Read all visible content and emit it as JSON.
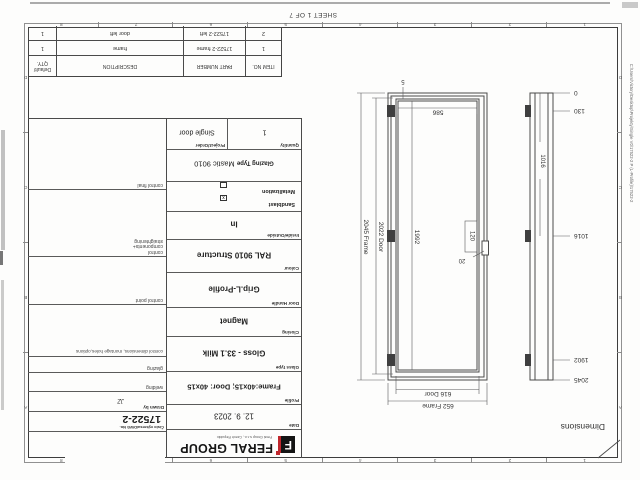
{
  "page": {
    "sheet_note": "SHEET 1 OF 7",
    "file_path": "C:\\Users\\Victory\\Desktop\\Projekty\\Single V0\\17522-2 P (L-Profile)\\17522-2"
  },
  "zones": {
    "numbers": [
      "1",
      "2",
      "3",
      "4",
      "5",
      "6",
      "7",
      "8"
    ],
    "letters": [
      "A",
      "B",
      "C",
      "D"
    ]
  },
  "drawing": {
    "view_label": "Dimensions",
    "dims": {
      "frame_width": "652 Frame",
      "door_width": "616 Door",
      "inner_width": "586",
      "frame_height": "2045 Frame",
      "door_height": "2022 Door",
      "inner_height": "1992",
      "bottom_gap": "5",
      "lock_box": "120",
      "lock_offset": "20",
      "bar_dim": "1016"
    },
    "ladder": [
      "0",
      "130",
      "1016",
      "1902",
      "2045"
    ]
  },
  "title_block": {
    "logo": {
      "text": "FERAL GROUP",
      "icon_letter": "F",
      "tagline": "Feral Group s.r.o., Czech Republic",
      "accent_color": "#c0272d"
    },
    "spec_rows": [
      {
        "label": "Date",
        "value": "12. 9. 2023"
      },
      {
        "label": "Profile",
        "value": "Frame:40x15; Door: 40x15"
      },
      {
        "label": "Glass type",
        "value": "Gloss - 33.1 Milk"
      },
      {
        "label": "Closing",
        "value": "Magnet"
      },
      {
        "label": "Door Handle",
        "value": "Grip.L-Profile"
      },
      {
        "label": "Colour",
        "value": "RAL 9010 Structure"
      },
      {
        "label": "Inside/Outside",
        "value": "In"
      }
    ],
    "sandblast": {
      "label": "Sandblast",
      "checked": "x"
    },
    "metallization": {
      "label": "Metallization"
    },
    "glazing_type": {
      "label": "Glazing Type",
      "value": "Mastic 9010"
    },
    "quantity": {
      "label": "Quantity",
      "value": "1"
    },
    "project": {
      "label": "Project/Order",
      "value": "Single door"
    },
    "dwg": {
      "label": "Číslo výkresu/DWG No.",
      "value": "17522-2"
    },
    "drawn_by": {
      "label": "Drawn by",
      "value": "JZ"
    },
    "qc_rows": [
      "welding",
      "glazing",
      "control dimensions, montage holes,options",
      "control point",
      "control components+ straightening",
      "control final"
    ]
  },
  "bom_table": {
    "headers": [
      "ITEM NO.",
      "PART NUMBER",
      "DESCRIPTION"
    ],
    "qty_header": [
      "Default/",
      "QTY."
    ],
    "rows": [
      [
        "1",
        "17522-2 frame",
        "frame",
        "1"
      ],
      [
        "2",
        "17522-2 left",
        "door left",
        "1"
      ]
    ]
  }
}
